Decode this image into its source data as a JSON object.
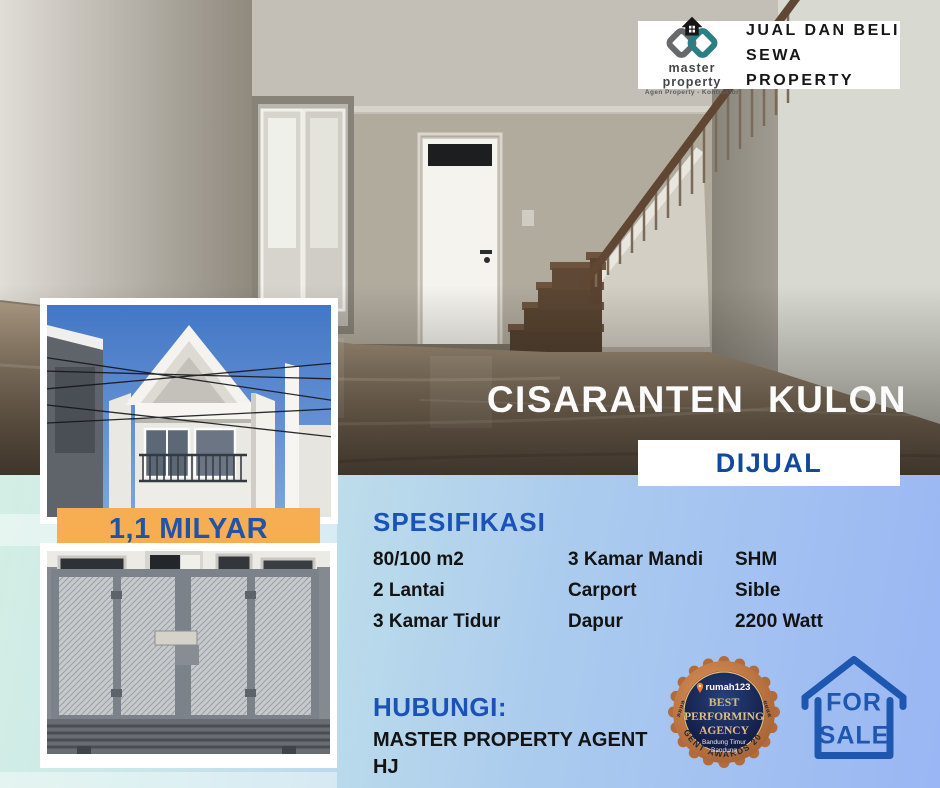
{
  "brand_card": {
    "name": "master property",
    "tagline": "Agen Property - Kontraktor",
    "line1": "JUAL DAN BELI",
    "line2": "SEWA PROPERTY"
  },
  "listing": {
    "title": "CISARANTEN  KULON",
    "status": "DIJUAL",
    "price": "1,1 MILYAR"
  },
  "specs": {
    "heading": "SPESIFIKASI",
    "col1": [
      "80/100 m2",
      "2 Lantai",
      "3 Kamar Tidur"
    ],
    "col2": [
      "3 Kamar Mandi",
      "Carport",
      "Dapur"
    ],
    "col3": [
      "SHM",
      "Sible",
      "2200 Watt"
    ]
  },
  "contact": {
    "heading": "HUBUNGI:",
    "line1": "MASTER PROPERTY AGENT",
    "line2": "HJ"
  },
  "award_badge": {
    "brand": "rumah123",
    "title1": "BEST",
    "title2": "PERFORMING",
    "title3": "AGENCY",
    "region1": "Bandung Timur",
    "region2": "Bandung",
    "arc_text": "AGENT AWARDS 2024",
    "chevrons_left": "»»»»",
    "chevrons_right": "««««"
  },
  "sale_sign": {
    "line1": "FOR",
    "line2": "SALE"
  },
  "colors": {
    "accent_blue": "#1b52b8",
    "status_blue": "#11499c",
    "price_orange": "#f7ad52",
    "gradient_left": "#d9f2e2",
    "gradient_right": "#9ab6f4",
    "sign_blue": "#1d57b0",
    "badge_copper": "#c07a45",
    "badge_navy": "#131b3e",
    "logo_teal": "#2b7e83",
    "logo_gray": "#67686b"
  }
}
